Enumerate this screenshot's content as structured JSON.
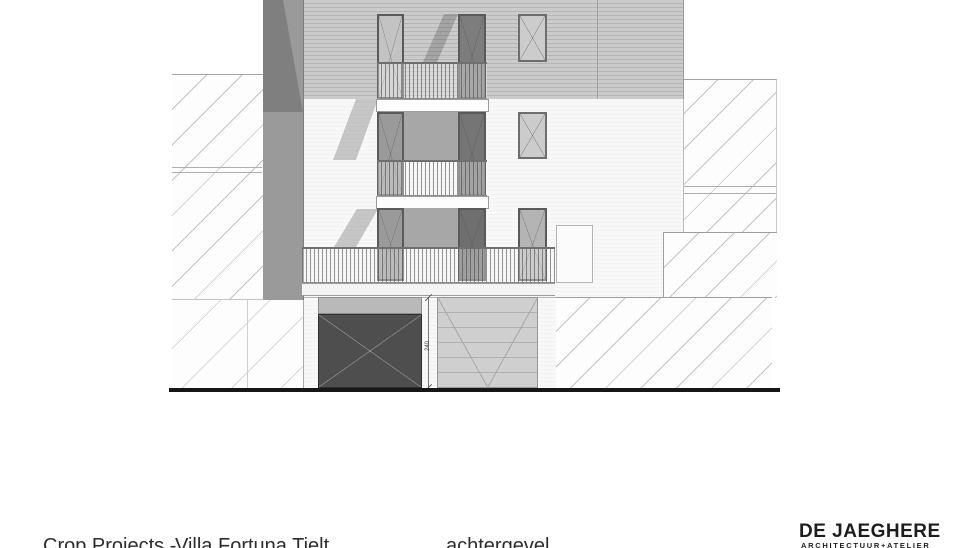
{
  "footer": {
    "client": "Crop Projects -",
    "project": "Villa Fortuna Tielt",
    "view_label": "achtergevel"
  },
  "logo": {
    "name": "DE JAEGHERE",
    "subtitle": "ARCHITECTUUR+ATELIER"
  },
  "drawing": {
    "type": "rear elevation (achtergevel)",
    "dimension_label": "240",
    "colors": {
      "siding_band": "#c9c9c9",
      "white_wall": "#f7f7f7",
      "side_band": "#9a9a9a",
      "shadow": "rgba(40,40,40,0.24)",
      "garage_door_dark": "#4e4e4e",
      "garage_door_light": "#cfcfcf",
      "ground_line": "#161616",
      "hatch_line": "#c3c3c3"
    }
  }
}
